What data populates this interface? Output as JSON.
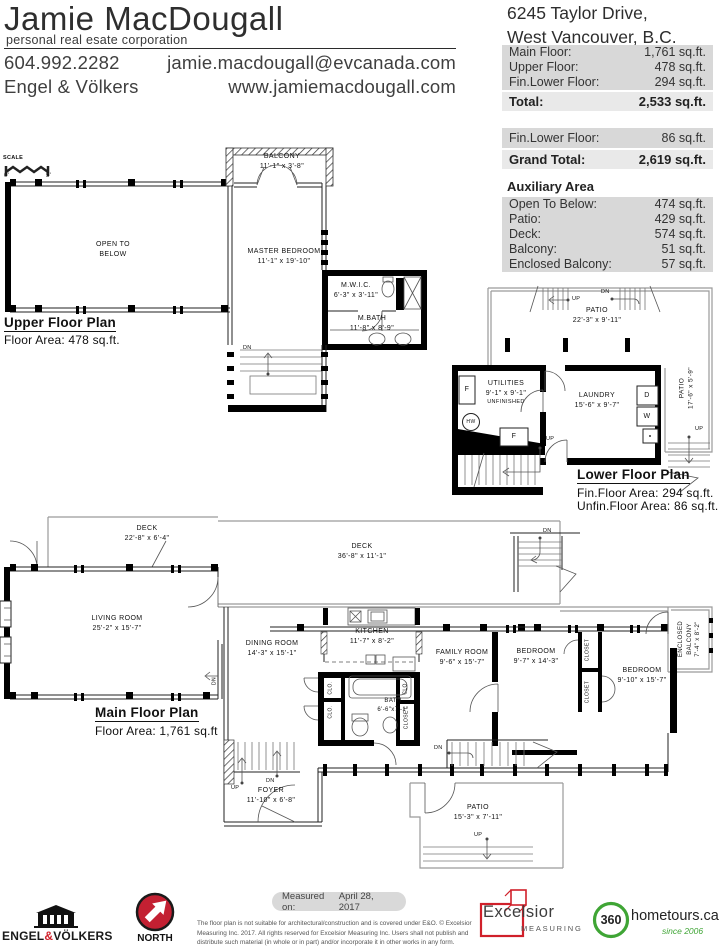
{
  "header": {
    "name": "Jamie MacDougall",
    "tagline": "personal real esate corporation",
    "phone": "604.992.2282",
    "email": "jamie.macdougall@evcanada.com",
    "brokerage": "Engel & Völkers",
    "website": "www.jamiemacdougall.com"
  },
  "property": {
    "address1": "6245 Taylor Drive,",
    "address2": "West Vancouver, B.C.",
    "main_areas": [
      {
        "label": "Main Floor:",
        "value": "1,761 sq.ft."
      },
      {
        "label": "Upper Floor:",
        "value": "478 sq.ft."
      },
      {
        "label": "Fin.Lower Floor:",
        "value": "294 sq.ft."
      }
    ],
    "total_label": "Total:",
    "total_value": "2,533 sq.ft.",
    "lower_label": "Fin.Lower Floor:",
    "lower_value": "86 sq.ft.",
    "grand_label": "Grand Total:",
    "grand_value": "2,619 sq.ft.",
    "aux_title": "Auxiliary Area",
    "aux_areas": [
      {
        "label": "Open To Below:",
        "value": "474 sq.ft."
      },
      {
        "label": "Patio:",
        "value": "429 sq.ft."
      },
      {
        "label": "Deck:",
        "value": "574 sq.ft."
      },
      {
        "label": "Balcony:",
        "value": "51 sq.ft."
      },
      {
        "label": "Enclosed Balcony:",
        "value": "57 sq.ft."
      }
    ]
  },
  "plans": {
    "upper": {
      "title": "Upper Floor Plan",
      "area": "Floor Area: 478 sq.ft.",
      "scale": "SCALE",
      "scale0": "0'",
      "scale5": "5'",
      "balcony_name": "BALCONY",
      "balcony_dim": "11'-1\" x 3'-8\"",
      "otb1": "OPEN TO",
      "otb2": "BELOW",
      "master_name": "MASTER BEDROOM",
      "master_dim": "11'-1\" x 19'-10\"",
      "mwic_name": "M.W.I.C.",
      "mwic_dim": "6'-3\" x 3'-11\"",
      "mbath_name": "M.BATH",
      "mbath_dim": "11'-8\" x 8'-9\"",
      "dn": "DN"
    },
    "lower": {
      "title": "Lower Floor Plan",
      "fin": "Fin.Floor Area: 294 sq.ft.",
      "unfin": "Unfin.Floor Area: 86 sq.ft.",
      "patio_name": "PATIO",
      "patio_dim": "22'-3\" x 9'-11\"",
      "utilities_name": "UTILITIES",
      "utilities_dim": "9'-1\" x 9'-1\"",
      "utilities_note": "UNFINISHED",
      "laundry_name": "LAUNDRY",
      "laundry_dim": "15'-6\" x 9'-7\"",
      "patio2_name": "PATIO",
      "patio2_dim": "17'-6\" x 5'-9\"",
      "up": "UP",
      "dn": "DN",
      "f": "F",
      "hw": "HW",
      "d": "D",
      "w": "W"
    },
    "main": {
      "title": "Main Floor Plan",
      "area": "Floor Area: 1,761 sq.ft",
      "deck1_name": "DECK",
      "deck1_dim": "22'-8\" x 6'-4\"",
      "deck2_name": "DECK",
      "deck2_dim": "36'-8\" x 11'-1\"",
      "living_name": "LIVING ROOM",
      "living_dim": "25'-2\" x 15'-7\"",
      "dining_name": "DINING ROOM",
      "dining_dim": "14'-3\" x 15'-1\"",
      "kitchen_name": "KITCHEN",
      "kitchen_dim": "11'-7\" x 8'-2\"",
      "bath_name": "BATH",
      "bath_dim": "6'-6\"x7'-1\"",
      "family_name": "FAMILY ROOM",
      "family_dim": "9'-6\" x 15'-7\"",
      "bed1_name": "BEDROOM",
      "bed1_dim": "9'-7\" x 14'-3\"",
      "bed2_name": "BEDROOM",
      "bed2_dim": "9'-10\" x 15'-7\"",
      "encl1": "ENCLOSED",
      "encl2": "BALCONY",
      "encl_dim": "7'-4\" x 8'-2\"",
      "foyer_name": "FOYER",
      "foyer_dim": "11'-10\" x 6'-8\"",
      "patio_name": "PATIO",
      "patio_dim": "15'-3\" x 7'-11\"",
      "clo": "CLO.",
      "closet": "CLOSET",
      "up": "UP",
      "dn": "DN"
    }
  },
  "footer": {
    "ev_1": "ENGEL",
    "ev_amp": "&",
    "ev_2": "VÖLKERS",
    "north": "NORTH",
    "measured_label": "Measured on:",
    "measured_date": "April 28, 2017",
    "disclaimer": "The floor plan is not suitable for architectural/construction and is covered under E&O. © Excelsior Measuring Inc. 2017. All rights reserved for Excelsior Measuring Inc. Users shall not publish and distribute such material (in whole or in part) and/or incorporate it in other works in any form.",
    "excelsior": "Excelsior",
    "excelsior_sub": "MEASURING",
    "ht_num": "360",
    "ht_name": "hometours.ca",
    "ht_since": "since 2006"
  },
  "colors": {
    "brand_red": "#c32032",
    "logo_red": "#d0202a",
    "brand_green": "#3fa535",
    "table_row": "#d8d8d8",
    "table_total": "#e9e9e9"
  }
}
